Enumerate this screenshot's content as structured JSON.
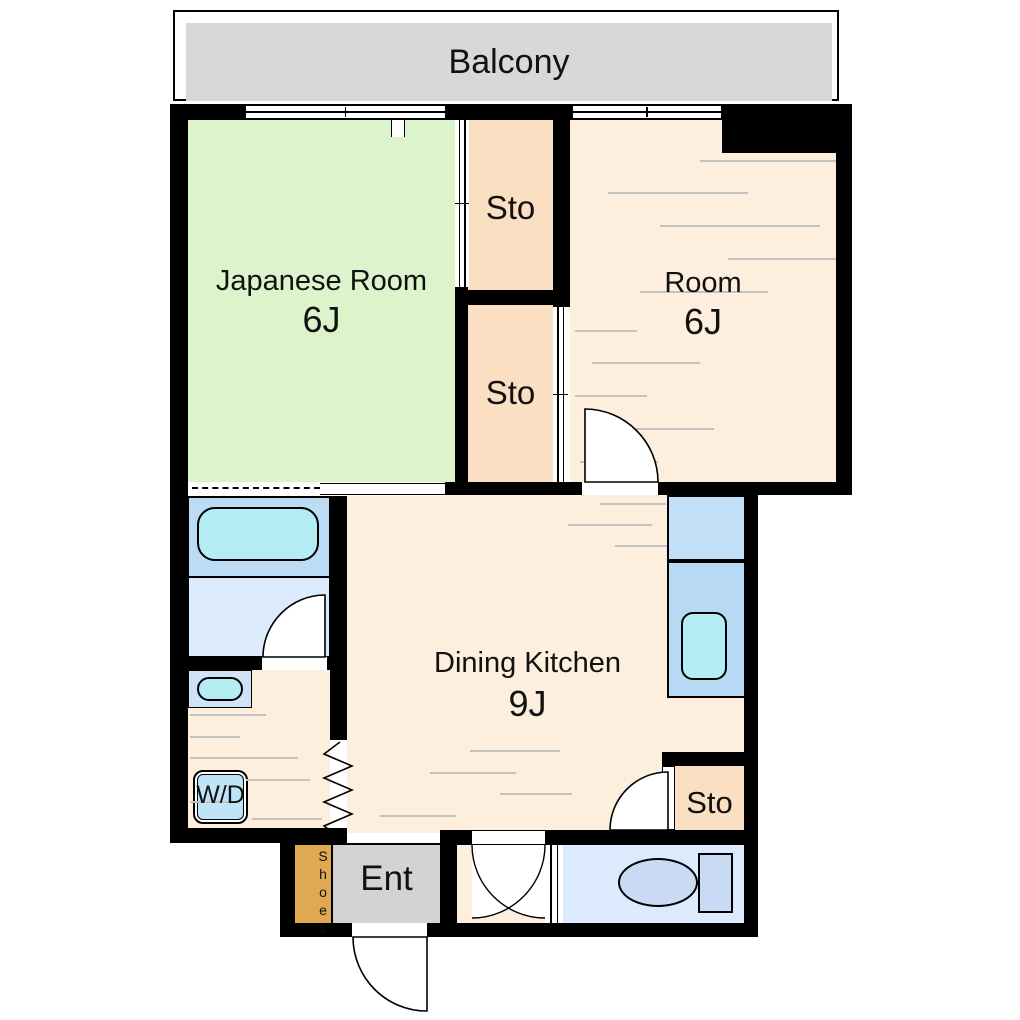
{
  "floorplan": {
    "balcony": "Balcony",
    "japanese_room": {
      "name": "Japanese Room",
      "size": "6J"
    },
    "room": {
      "name": "Room",
      "size": "6J"
    },
    "dining_kitchen": {
      "name": "Dining Kitchen",
      "size": "9J"
    },
    "storage_upper": "Sto",
    "storage_lower": "Sto",
    "storage_entry": "Sto",
    "entrance": "Ent",
    "shoe_cabinet": "Shoes",
    "washer_dryer": "W/D"
  },
  "colors": {
    "wall": "#000000",
    "balcony_floor": "#d8d8d8",
    "tatami_green": "#dcf3cc",
    "storage_peach": "#fbdfc2",
    "wood_floor_cream": "#fdeedd",
    "entrance_gray": "#d3d3d3",
    "shoe_cabinet_tan": "#dfa952",
    "counter_blue_upper": "#c3e0f9",
    "counter_blue_lower": "#b7d9f4",
    "sink_cyan": "#b4ecf4",
    "bath_blue": "#bcdcf5",
    "bath_floor_blue": "#dcebfb",
    "washbasin_blue": "#cfe2f8",
    "toilet_room_blue": "#dbeafc",
    "toilet_fixture_blue": "#c8daf4",
    "washer_dryer_blue": "#bfe3f7",
    "floor_line_gray": "#c2c2c2"
  }
}
